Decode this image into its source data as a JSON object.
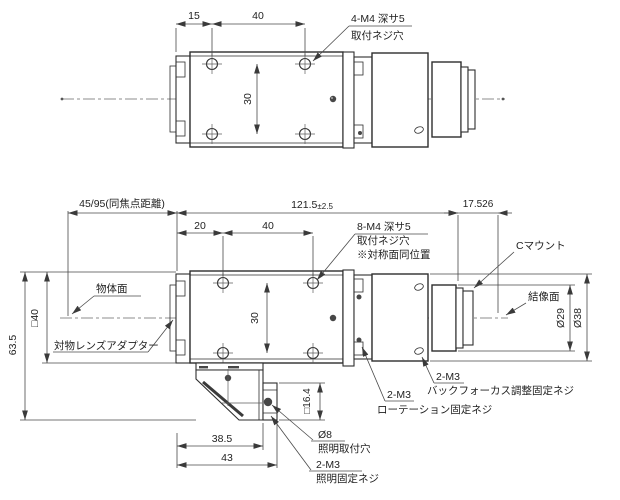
{
  "top_view": {
    "dim_front_to_hole": "15",
    "dim_hole_spacing": "40",
    "dim_hole_spacing_v": "30",
    "mount_holes_label_1": "4-M4 深サ5",
    "mount_holes_label_2": "取付ネジ穴"
  },
  "side_view": {
    "dim_parfocal": "45/95(同焦点距離)",
    "dim_overall": "121.5",
    "dim_overall_tol": "±2.5",
    "dim_flange_back": "17.526",
    "dim_front_to_hole": "20",
    "dim_hole_spacing": "40",
    "dim_hole_spacing_v": "30",
    "mount_holes_label_1": "8-M4 深サ5",
    "mount_holes_label_2": "取付ネジ穴",
    "mount_holes_label_3": "※対称面同位置",
    "c_mount_label": "Cマウント",
    "image_plane_label": "結像面",
    "dia_29": "Ø29",
    "dia_38": "Ø38",
    "dim_height": "63.5",
    "dim_body_square": "□40",
    "object_plane_label": "物体面",
    "objective_adapter_label": "対物レンズアダプター",
    "rotation_screw_label_1": "2-M3",
    "rotation_screw_label_2": "ローテーション固定ネジ",
    "backfocus_screw_label_1": "2-M3",
    "backfocus_screw_label_2": "バックフォーカス調整固定ネジ",
    "dim_bracket_width": "38.5",
    "dim_bracket_width_full": "43",
    "dim_illum_square": "□16.4",
    "illum_hole_label_1": "Ø8",
    "illum_hole_label_2": "照明取付穴",
    "illum_screw_label_1": "2-M3",
    "illum_screw_label_2": "照明固定ネジ"
  },
  "colors": {
    "background": "#ffffff",
    "outline": "#2e2e2e",
    "dimension_line": "#4a4a4a",
    "centerline": "#8c8c8c",
    "text": "#1f1f1f"
  }
}
